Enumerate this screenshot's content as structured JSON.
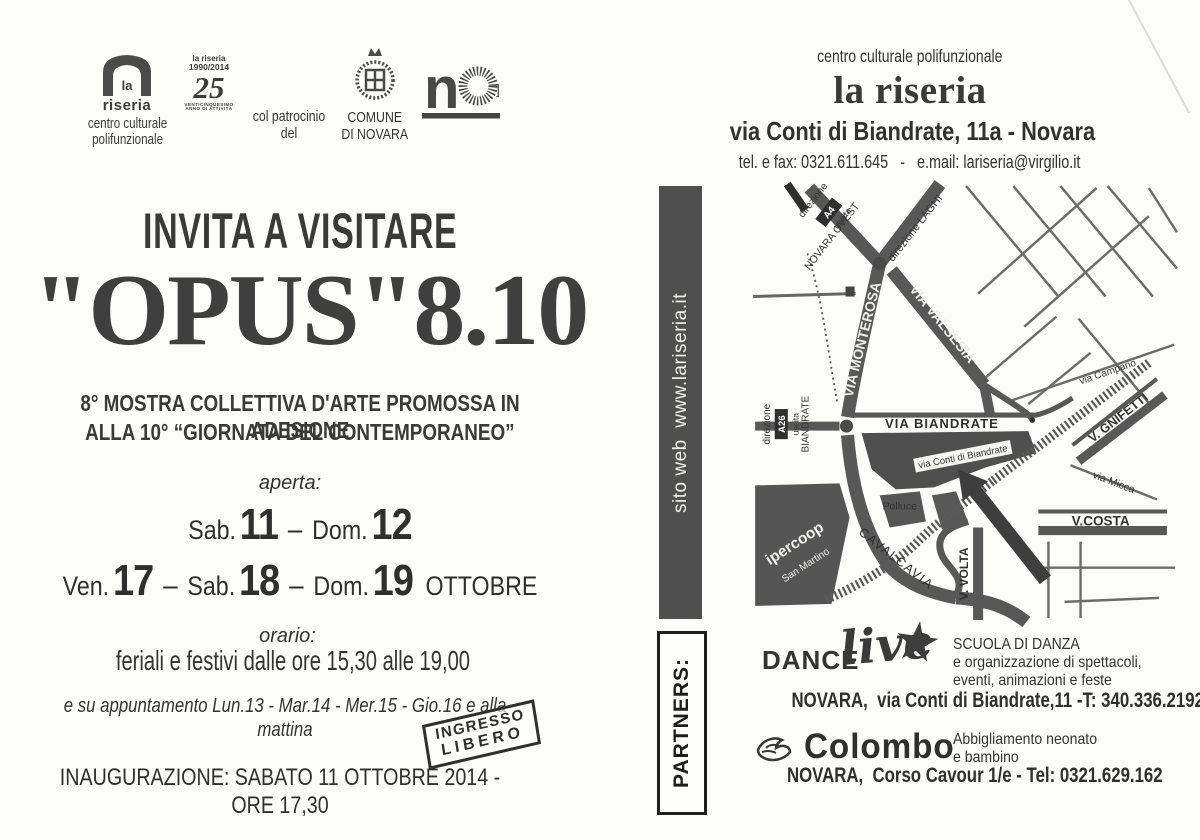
{
  "page": {
    "ink": "#383838",
    "bar_bg": "#4f4f4f",
    "map_road": "#585858",
    "map_block": "#4f4f4f"
  },
  "left": {
    "logos": {
      "riseria": {
        "la": "la",
        "riseria": "riseria",
        "caption1": "centro culturale",
        "caption2": "polifunzionale"
      },
      "anniversary": {
        "top1": "la riseria",
        "top2": "1990/2014",
        "num": "25",
        "cap1": "VENTICINQUESIMO",
        "cap2": "ANNO DI ATTIVITÀ"
      },
      "patronage": "col patrocinio del",
      "comune1": "COMUNE",
      "comune2": "DI NOVARA"
    },
    "invite": "INVITA A VISITARE",
    "title": "\"OPUS\"8.10",
    "subtitle1": "8° MOSTRA COLLETTIVA D'ARTE PROMOSSA IN ADESIONE",
    "subtitle2": "ALLA 10° “GIORNATA DEL CONTEMPORANEO”",
    "aperta": "aperta:",
    "dates1": {
      "d1": "Sab.",
      "n1": "11",
      "s1": "–",
      "d2": "Dom.",
      "n2": "12"
    },
    "dates2": {
      "d1": "Ven.",
      "n1": "17",
      "s1": "–",
      "d2": "Sab.",
      "n2": "18",
      "s2": "–",
      "d3": "Dom.",
      "n3": "19",
      "month": "OTTOBRE"
    },
    "orario": "orario:",
    "hours": "feriali e festivi dalle ore 15,30 alle 19,00",
    "appointment": "e su appuntamento Lun.13 - Mar.14 - Mer.15 - Gio.16  e alla mattina",
    "stamp1": "INGRESSO",
    "stamp2": "LIBERO",
    "inauguration": "INAUGURAZIONE: SABATO 11 OTTOBRE 2014  - ORE 17,30"
  },
  "right": {
    "tagline": "centro culturale polifunzionale",
    "brand": "la riseria",
    "address": "via Conti di Biandrate, 11a - Novara",
    "contact": "tel. e fax: 0321.611.645   -   e.mail: lariseria@virgilio.it",
    "site_bar": "sito web  www.lariseria.it",
    "partners_label": "PARTNERS:",
    "map": {
      "labels": {
        "direzione_a4": "direzione",
        "a4_badge": "A4",
        "uscita_no": "uscita",
        "novara_ovest": "NOVARA OVEST",
        "direzione_laghi": "direzione LAGHI",
        "via_monterosa": "VIA MONTEROSA",
        "via_valsesia": "VIA VALSESIA",
        "via_campano": "via Campano",
        "direzione_a26": "direzione",
        "a26_badge": "A26",
        "uscita_bi": "uscita",
        "biandrate_exit": "BIANDRATE",
        "via_biandrate": "VIA BIANDRATE",
        "via_conti": "via Conti di Biandrate",
        "v_gnifetti": "V. GNIFETTI",
        "via_micca": "via Micca",
        "v_costa": "V.COSTA",
        "polluce": "Polluce",
        "ipercoop": "ipercoop",
        "san_martino": "San Martino",
        "cavalcavia": "CAVALCAVIA",
        "v_volta": "V. VOLTA"
      }
    },
    "dance": {
      "brand_bold": "DANCE",
      "brand_script": "live",
      "star": "★",
      "desc1": "SCUOLA DI DANZA",
      "desc2": "e organizzazione di spettacoli,",
      "desc3": "eventi, animazioni e feste",
      "address": "NOVARA,  via Conti di Biandrate,11 -T: 340.336.2192"
    },
    "colombo": {
      "brand": "Colombo",
      "desc1": "Abbigliamento neonato",
      "desc2": "e bambino",
      "address": "NOVARA,  Corso Cavour 1/e - Tel: 0321.629.162"
    }
  }
}
